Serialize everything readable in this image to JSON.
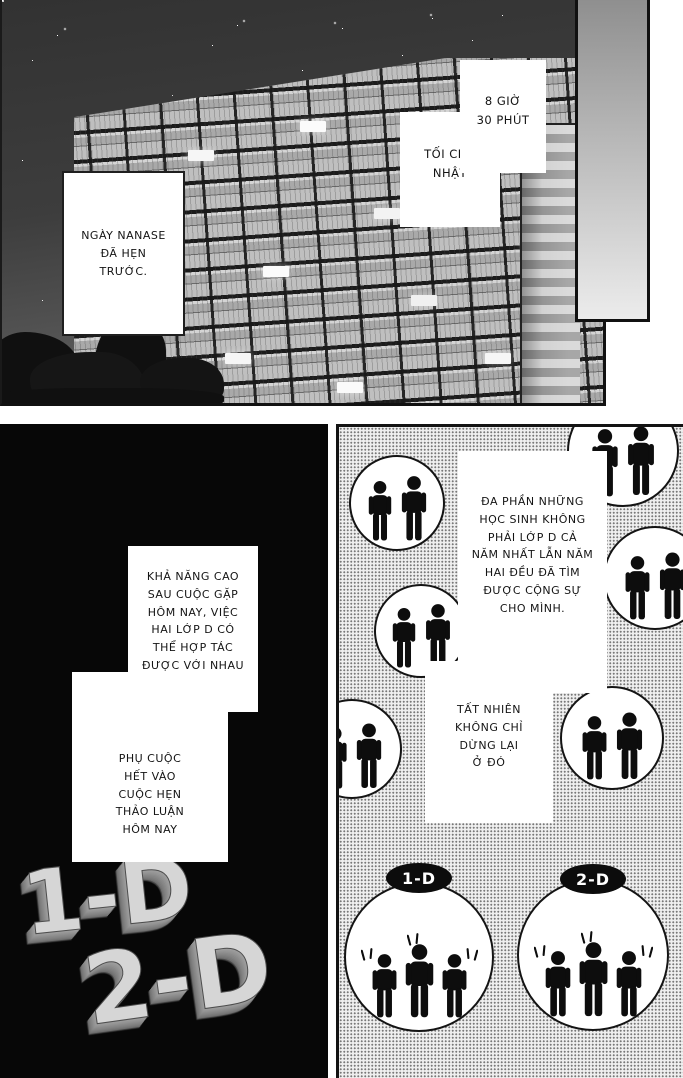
{
  "panel_top": {
    "time_caption": "8 GIỜ\n30 PHÚT",
    "evening_caption": "TỐI CHỦ\nNHẬT",
    "nanase_caption": "NGÀY NANASE\nĐÃ HẸN\nTRƯỚC."
  },
  "panel_left": {
    "class_title_top": "1-D",
    "class_title_bottom": "2-D",
    "caption_possibility": "KHẢ NĂNG CAO\nSAU CUỘC GẶP\nHÔM NAY, VIỆC\nHAI LỚP D CÓ\nTHỂ HỢP TÁC\nĐƯỢC VỚI NHAU\nHAY KHÔNG",
    "caption_depends": "PHỤ CUỘC\nHẾT VÀO\nCUỘC HẸN\nTHẢO LUẬN\nHÔM NAY"
  },
  "panel_right": {
    "caption_students": "ĐA PHẦN NHỮNG\nHỌC SINH KHÔNG\nPHẢI LỚP D CẢ\nNĂM NHẤT LẪN NĂM\nHAI ĐỀU ĐÃ TÌM\nĐƯỢC CỘNG SỰ\nCHO MÌNH.",
    "caption_ofcourse": "TẤT NHIÊN\nKHÔNG CHỈ\nDỪNG LẠI\nỞ ĐÓ",
    "badge_1d": "1-D",
    "badge_2d": "2-D"
  },
  "icons": {
    "person": "person-icon",
    "surprise_marks": "surprise-marks-icon"
  },
  "colors": {
    "ink": "#111111",
    "sky_top": "#323232",
    "sky_bottom": "#7e7e7e",
    "panel_black": "#070707",
    "halftone_dot": "#787878",
    "letter_face": "#d6d6d6",
    "badge_bg": "#0c0c0c",
    "badge_text": "#ffffff"
  }
}
